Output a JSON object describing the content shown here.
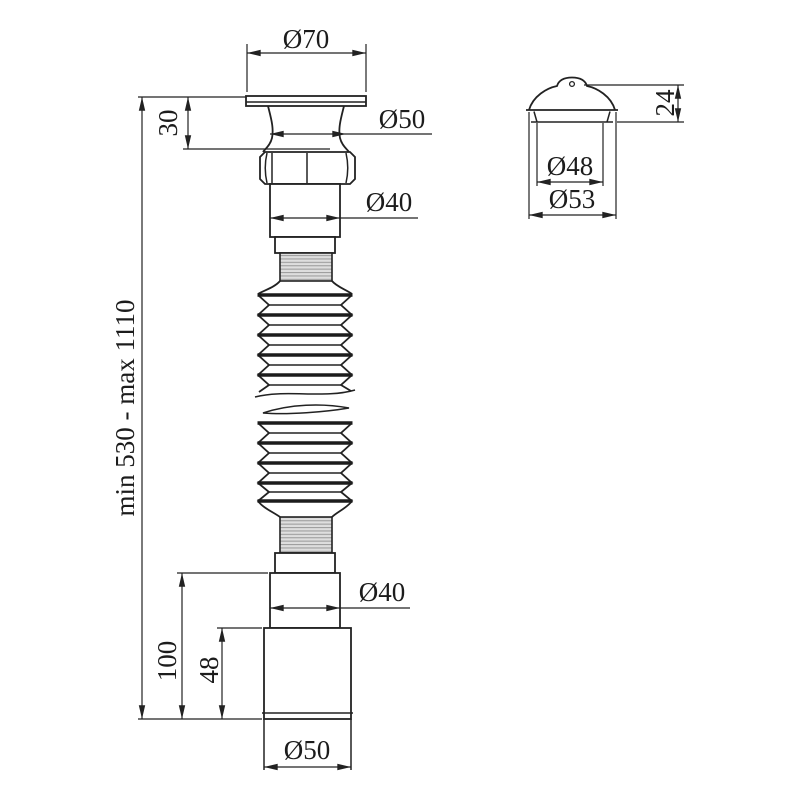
{
  "drawing": {
    "type": "technical-dimension-drawing",
    "subject": "flexible corrugated siphon drain pipe with strainer and cap",
    "colors": {
      "line": "#222222",
      "background": "#ffffff",
      "thread_fill": "#dedede",
      "thread_stripe": "#9e9e9e"
    }
  },
  "labels": {
    "top_diameter": "Ø70",
    "cup_diameter": "Ø50",
    "cup_height": "30",
    "upper_pipe_diameter": "Ø40",
    "total_length": "min 530 - max 1110",
    "lower_pipe_diameter": "Ø40",
    "outlet_total_height": "100",
    "outlet_body_height": "48",
    "outlet_diameter": "Ø50",
    "cap_height": "24",
    "cap_inner_diameter": "Ø48",
    "cap_outer_diameter": "Ø53"
  }
}
